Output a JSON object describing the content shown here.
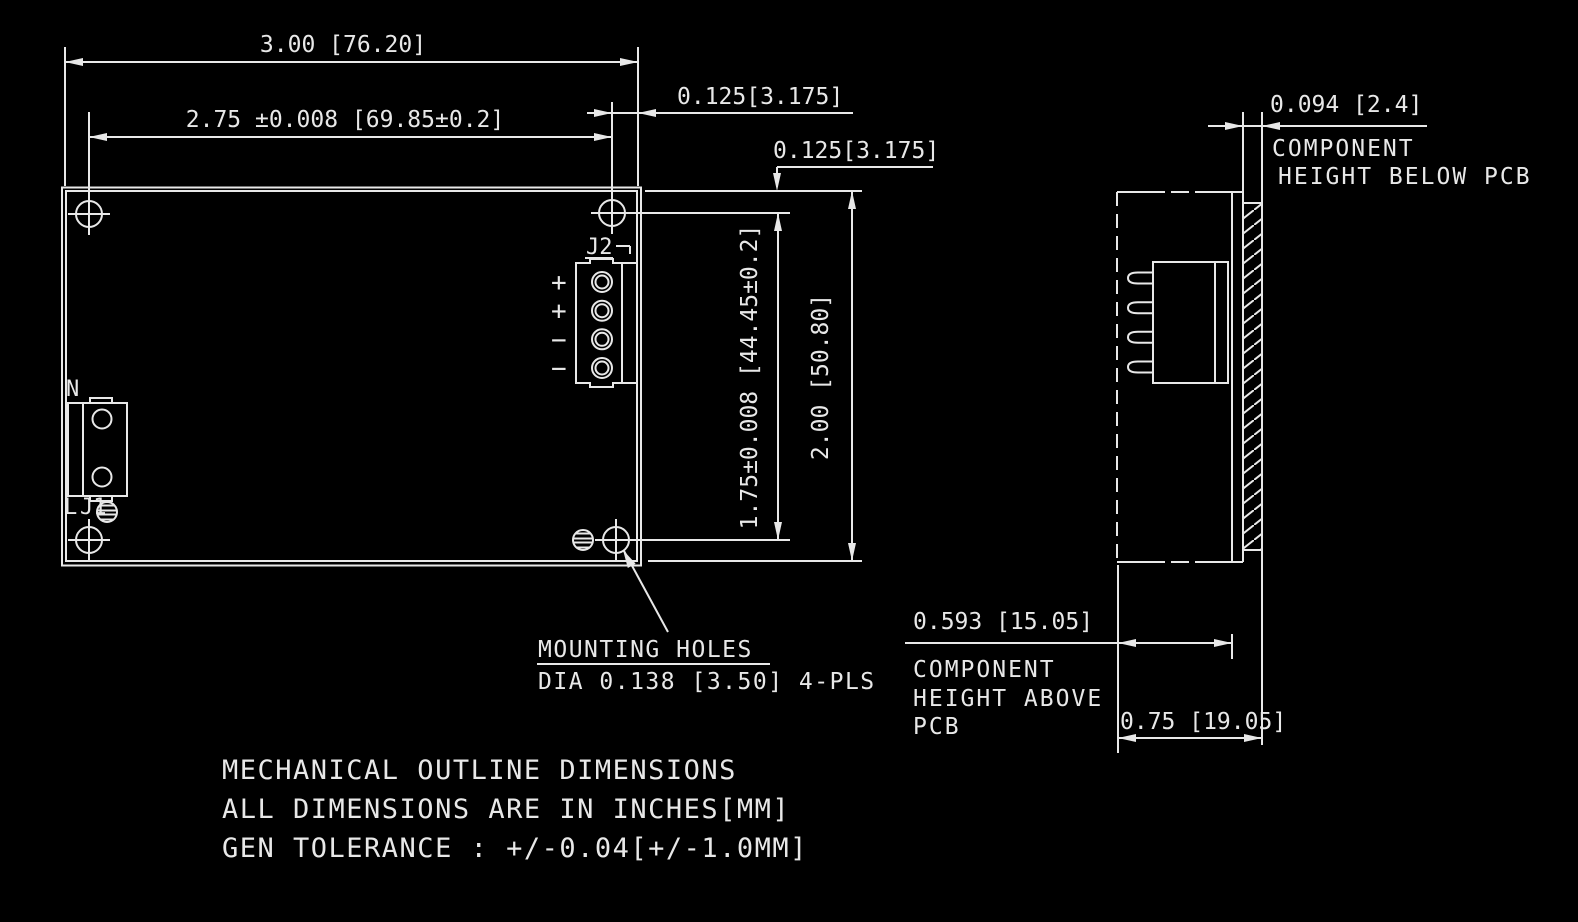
{
  "colors": {
    "background": "#000000",
    "line": "#e8e8e8"
  },
  "drawing_notes": {
    "line1": "MECHANICAL OUTLINE DIMENSIONS",
    "line2": "ALL DIMENSIONS ARE IN INCHES[MM]",
    "line3": "GEN TOLERANCE : +/-0.04[+/-1.0MM]"
  },
  "top_view": {
    "dim_overall_width": "3.00 [76.20]",
    "dim_hole_span_horizontal": "2.75 ±0.008 [69.85±0.2]",
    "dim_hole_edge_offset_horizontal": "0.125[3.175]",
    "dim_hole_edge_offset_vertical": "0.125[3.175]",
    "dim_hole_span_vertical": "1.75±0.008 [44.45±0.2]",
    "dim_overall_height": "2.00 [50.80]",
    "j2": {
      "designator": "J2",
      "pin_labels": [
        "+",
        "+",
        "−",
        "−"
      ]
    },
    "j1": {
      "designator": "J1",
      "pin_top": "N",
      "pin_bottom": "L"
    },
    "mounting_holes": {
      "title": "MOUNTING HOLES",
      "spec": "DIA 0.138 [3.50] 4-PLS"
    }
  },
  "side_view": {
    "dim_component_height_below_pcb": "0.094 [2.4]",
    "label_below_pcb_line1": "COMPONENT",
    "label_below_pcb_line2": "HEIGHT BELOW PCB",
    "dim_component_height_above_pcb": "0.593 [15.05]",
    "label_above_pcb_line1": "COMPONENT",
    "label_above_pcb_line2": "HEIGHT ABOVE",
    "label_above_pcb_line3": "PCB",
    "dim_total_height": "0.75 [19.05]"
  }
}
